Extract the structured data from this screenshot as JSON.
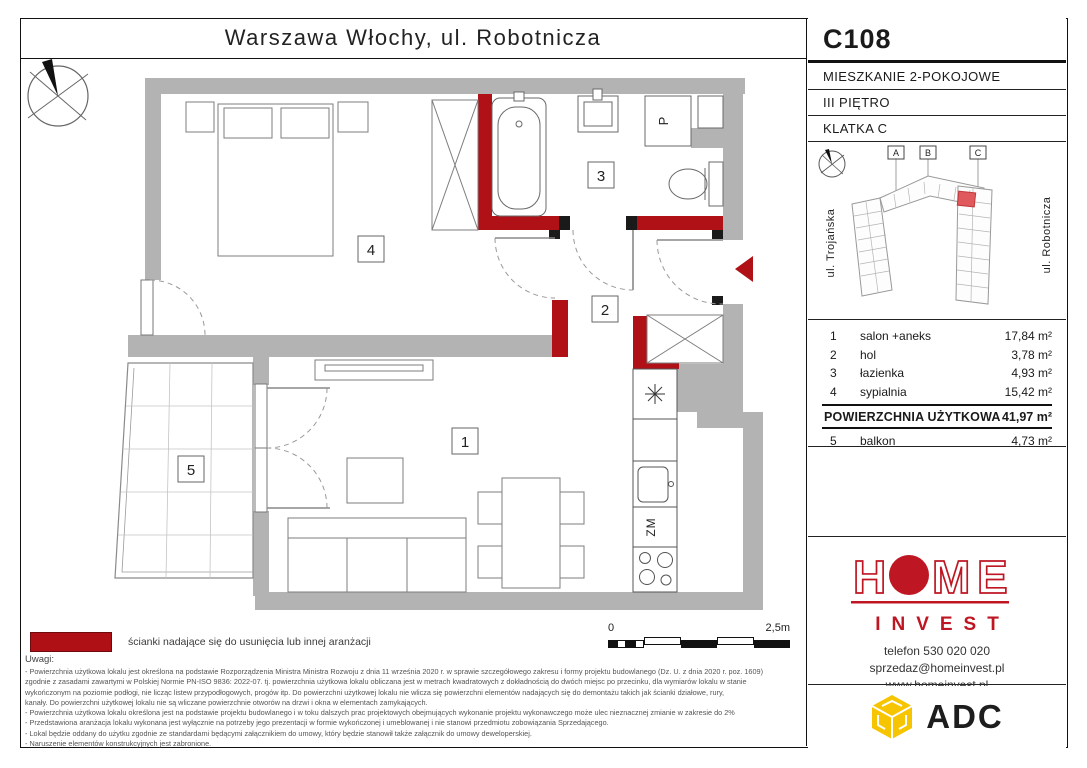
{
  "title": "Warszawa Włochy, ul. Robotnicza",
  "unit": {
    "code": "C108",
    "type": "MIESZKANIE 2-POKOJOWE",
    "floor": "III PIĘTRO",
    "staircase": "KLATKA C"
  },
  "site_plan": {
    "labels": [
      "A",
      "B",
      "C"
    ],
    "street_left": "ul. Trojańska",
    "street_right": "ul. Robotnicza"
  },
  "rooms": [
    {
      "num": "1",
      "name": "salon +aneks",
      "area": "17,84 m²"
    },
    {
      "num": "2",
      "name": "hol",
      "area": "3,78 m²"
    },
    {
      "num": "3",
      "name": "łazienka",
      "area": "4,93 m²"
    },
    {
      "num": "4",
      "name": "sypialnia",
      "area": "15,42 m²"
    }
  ],
  "total": {
    "label": "POWIERZCHNIA UŻYTKOWA",
    "area": "41,97 m²"
  },
  "balcony_row": {
    "num": "5",
    "name": "balkon",
    "area": "4,73 m²"
  },
  "plan": {
    "label_1": "1",
    "label_2": "2",
    "label_3": "3",
    "label_4": "4",
    "label_5": "5",
    "washer_label": "P",
    "dishwasher_label": "ZM"
  },
  "scale_bar": {
    "start": "0",
    "end": "2,5m"
  },
  "legend": "ścianki nadające się do usunięcia lub innej aranżacji",
  "notes": {
    "heading": "Uwagi:",
    "lines": [
      "- Powierzchnia użytkowa lokalu jest określona na podstawie Rozporządzenia Ministra Ministra Rozwoju z dnia 11 września 2020 r. w sprawie szczegółowego zakresu i formy projektu budowlanego (Dz. U. z dnia 2020 r. poz. 1609)",
      "zgodnie z zasadami zawartymi w Polskiej Normie PN-ISO 9836: 2022-07. tj. powierzchnia użytkowa lokalu obliczana jest w metrach kwadratowych z dokładnością do dwóch miejsc po przecinku, dla wymiarów lokalu w stanie",
      "wykończonym na poziomie podłogi, nie licząc listew przypodłogowych, progów itp. Do powierzchni użytkowej lokalu nie wlicza się powierzchni elementów nadających się do demontażu takich jak ścianki działowe, rury,",
      "kanały. Do powierzchni użytkowej lokalu nie są wliczane powierzchnie otworów na drzwi i okna w elementach zamykających.",
      "- Powierzchnia użytkowa lokalu określona jest na podstawie projektu budowlanego i w toku dalszych prac projektowych obejmujących wykonanie projektu wykonawczego może ulec nieznacznej zmianie w zakresie do 2%",
      "- Przedstawiona aranżacja lokalu wykonana jest wyłącznie na potrzeby jego prezentacji w formie wykończonej i umeblowanej i nie stanowi przedmiotu zobowiązania Sprzedającego.",
      "- Lokal będzie oddany do użytku zgodnie ze standardami będącymi załącznikiem do umowy, który będzie stanowił także załącznik do umowy deweloperskiej.",
      "- Naruszenie elementów konstrukcyjnych jest zabronione."
    ]
  },
  "developer": {
    "logo_h": "H",
    "logo_m": "M",
    "logo_e": "E",
    "logo_sub": "INVEST",
    "phone": "telefon 530 020 020",
    "email": "sprzedaz@homeinvest.pl",
    "website": "www.homeinvest.pl"
  },
  "partner": {
    "name": "ADC"
  },
  "colors": {
    "wall_gray": "#b3b3b3",
    "removable_red": "#b01116",
    "brand_red": "#be1622",
    "adc_yellow": "#f6c500"
  }
}
